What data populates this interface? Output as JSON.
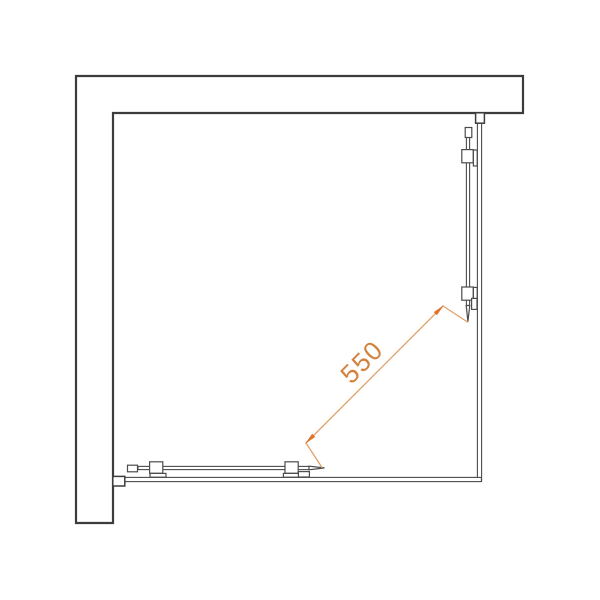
{
  "diagram": {
    "kind": "shower-enclosure-top-view",
    "background": "#ffffff",
    "wall_color": "#3c3c3c",
    "glass_color": "#4c4c4c",
    "dimension": {
      "label": "550",
      "text_color": "#d4813c",
      "line_color": "#e0a268",
      "arrow_color": "#dd7428"
    }
  }
}
